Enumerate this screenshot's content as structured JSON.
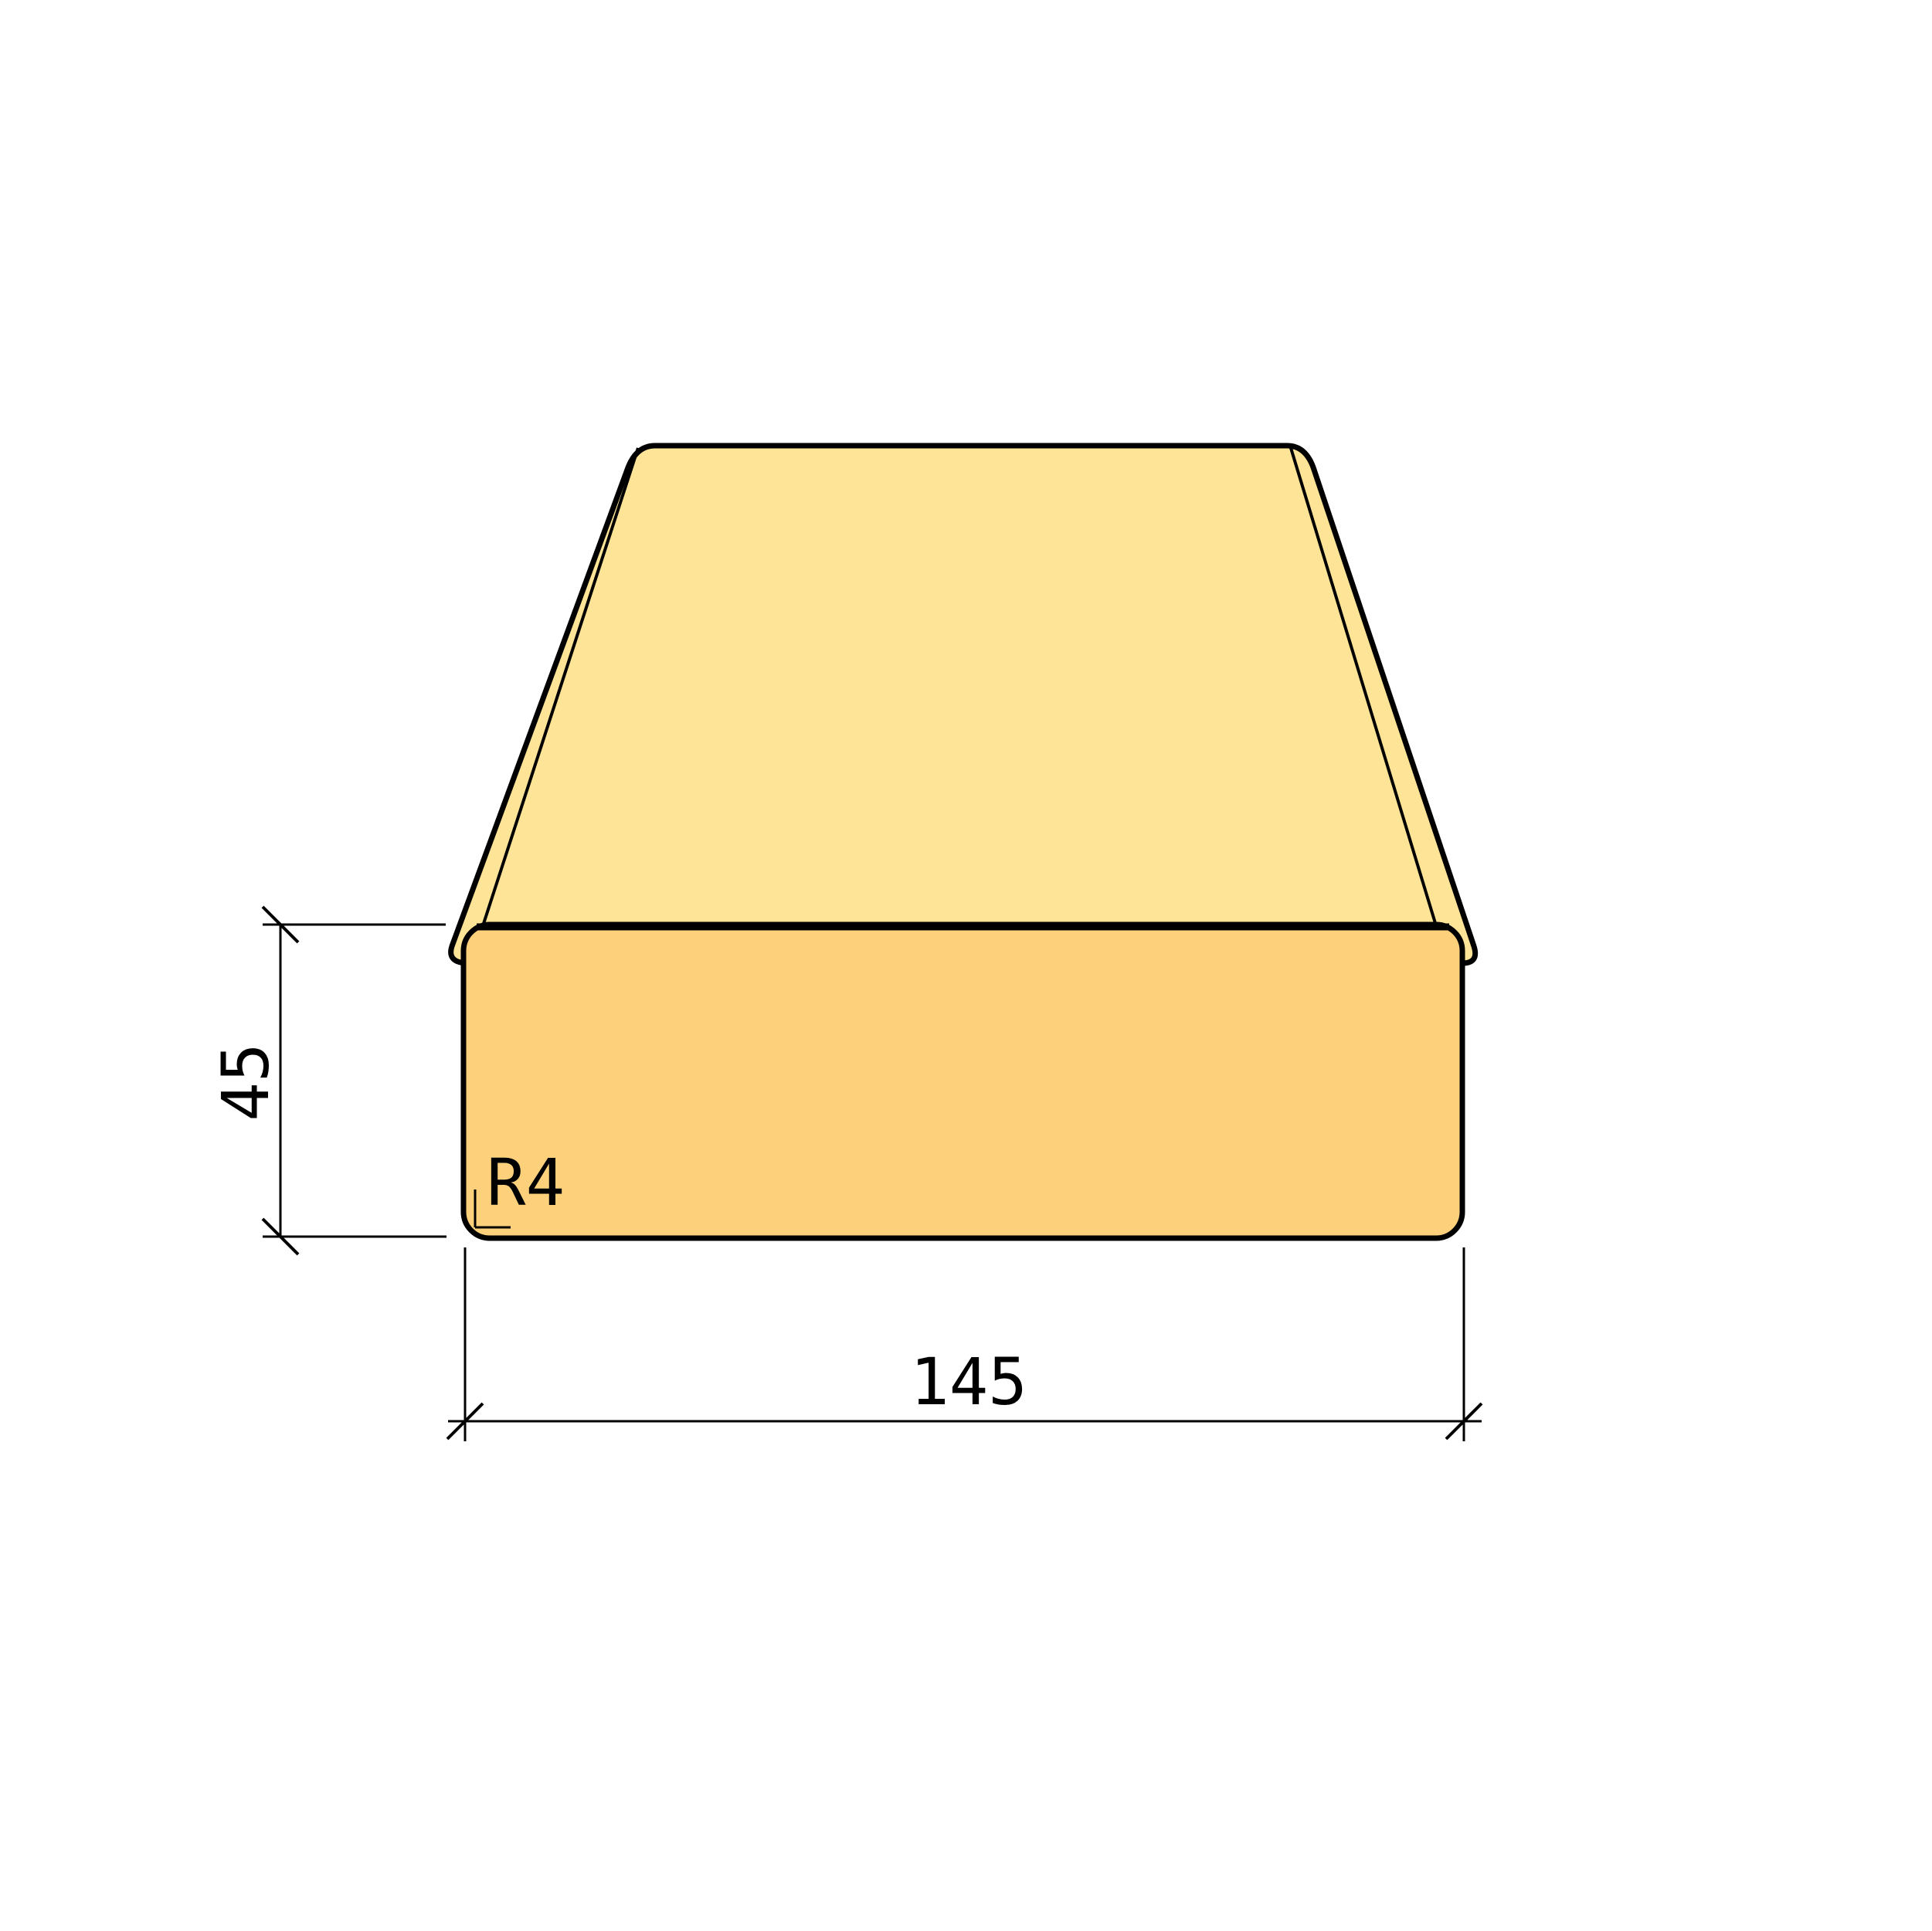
{
  "drawing": {
    "subject": "planed-timber-board-cross-section",
    "dimension_height": {
      "value": "45"
    },
    "dimension_width": {
      "value": "145"
    },
    "corner_radius": {
      "value": "R4"
    },
    "colors": {
      "top-face": "#FDE496",
      "front-face": "#FDD17B",
      "line": "#000000",
      "background": "#FFFFFF"
    }
  }
}
